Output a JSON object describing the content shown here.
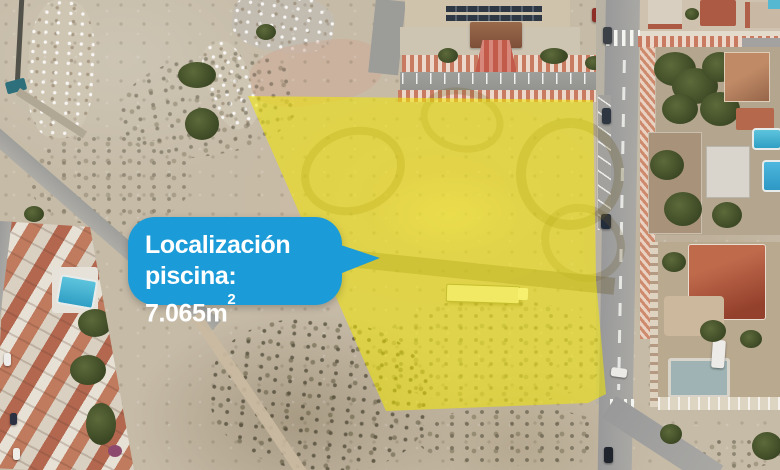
{
  "annotation": {
    "line1": "Localización",
    "line2": "piscina: 7.065m",
    "superscript": "2",
    "bubble_color": "#1b9cd8",
    "text_color": "#ffffff"
  },
  "overlay": {
    "fill_color": "#f3e800",
    "opacity": 0.55
  }
}
